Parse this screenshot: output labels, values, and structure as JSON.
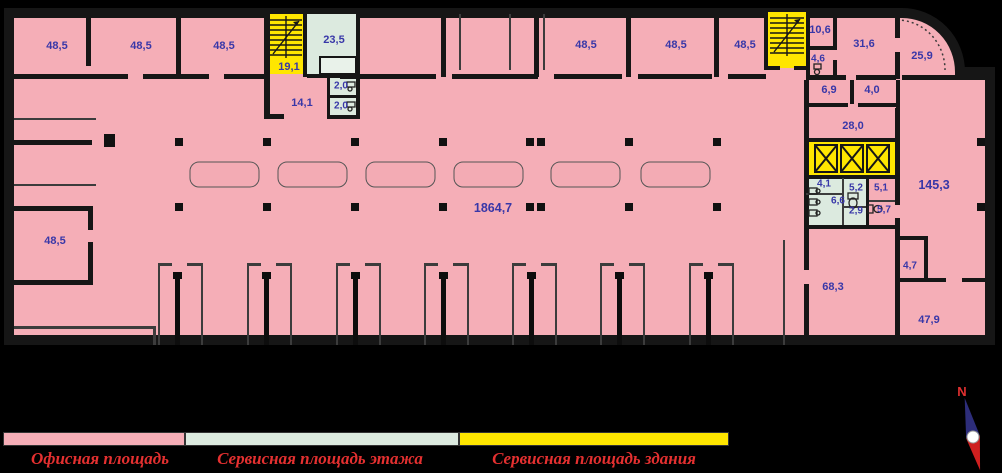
{
  "title": "Floor plan",
  "colors": {
    "background": "#000000",
    "office_pink": "#f5aeb7",
    "service_floor_mint": "#dceadf",
    "service_building_yellow": "#ffe600",
    "wall": "#161616",
    "room_label_text": "#3837a8",
    "legend_text": "#e43030"
  },
  "plan": {
    "total_hall_area": "1864,7",
    "labels": [
      {
        "text": "48,5"
      },
      {
        "text": "48,5"
      },
      {
        "text": "48,5"
      },
      {
        "text": "19,1"
      },
      {
        "text": "23,5"
      },
      {
        "text": "14,1"
      },
      {
        "text": "2,0"
      },
      {
        "text": "2,0"
      },
      {
        "text": "48,5"
      },
      {
        "text": "48,5"
      },
      {
        "text": "48,5"
      },
      {
        "text": "10,6"
      },
      {
        "text": "31,6"
      },
      {
        "text": "25,9"
      },
      {
        "text": "4,6"
      },
      {
        "text": "6,9"
      },
      {
        "text": "4,0"
      },
      {
        "text": "28,0"
      },
      {
        "text": "4,1"
      },
      {
        "text": "5,2"
      },
      {
        "text": "5,1"
      },
      {
        "text": "6,6"
      },
      {
        "text": "2,9"
      },
      {
        "text": "5,7"
      },
      {
        "text": "145,3"
      },
      {
        "text": "1864,7"
      },
      {
        "text": "48,5"
      },
      {
        "text": "68,3"
      },
      {
        "text": "4,7"
      },
      {
        "text": "47,9"
      }
    ]
  },
  "legend": {
    "items": [
      {
        "label": "Офисная площадь",
        "color": "#f5aeb7"
      },
      {
        "label": "Сервисная площадь этажа",
        "color": "#dceadf"
      },
      {
        "label": "Сервисная площадь здания",
        "color": "#ffe600"
      }
    ]
  },
  "compass": {
    "north_label": "N"
  }
}
